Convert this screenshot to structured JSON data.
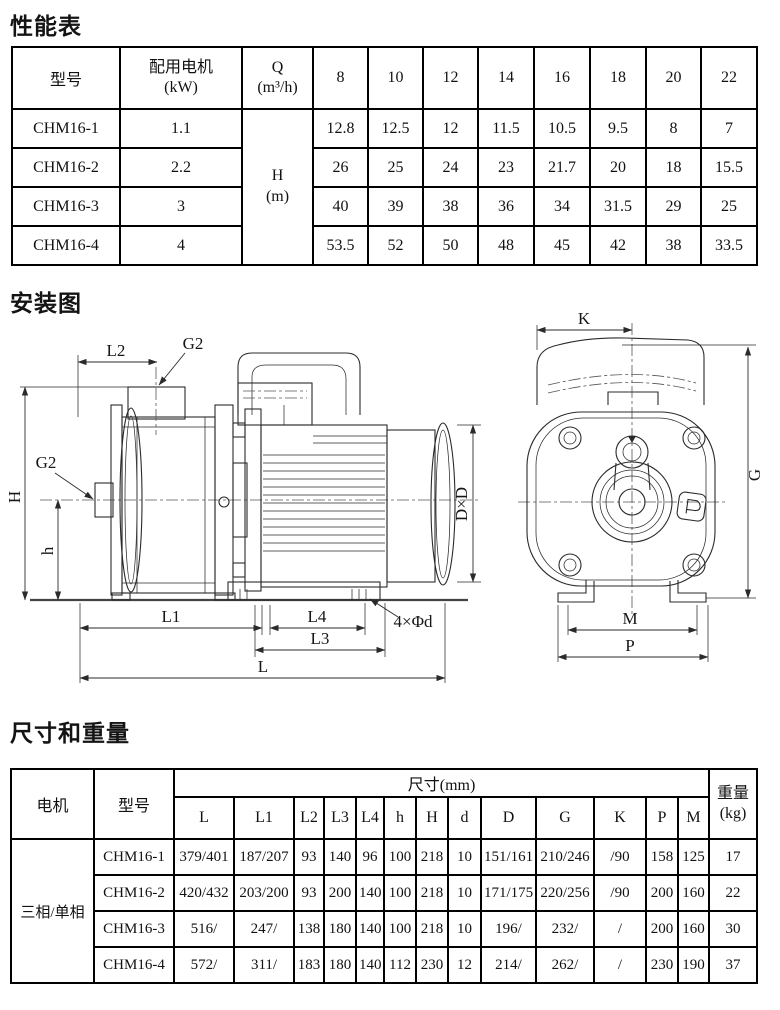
{
  "page": {
    "perf_title": "性能表",
    "install_title": "安装图",
    "dims_title": "尺寸和重量"
  },
  "perf_table": {
    "col_model": "型号",
    "col_motor": "配用电机",
    "col_motor_unit": "(kW)",
    "col_q": "Q",
    "col_q_unit": "(m³/h)",
    "flows": [
      "8",
      "10",
      "12",
      "14",
      "16",
      "18",
      "20",
      "22"
    ],
    "h_label": "H",
    "h_unit": "(m)",
    "rows": [
      {
        "c": [
          "CHM16-1",
          "1.1",
          "12.8",
          "12.5",
          "12",
          "11.5",
          "10.5",
          "9.5",
          "8",
          "7"
        ]
      },
      {
        "c": [
          "CHM16-2",
          "2.2",
          "26",
          "25",
          "24",
          "23",
          "21.7",
          "20",
          "18",
          "15.5"
        ]
      },
      {
        "c": [
          "CHM16-3",
          "3",
          "40",
          "39",
          "38",
          "36",
          "34",
          "31.5",
          "29",
          "25"
        ]
      },
      {
        "c": [
          "CHM16-4",
          "4",
          "53.5",
          "52",
          "50",
          "48",
          "45",
          "42",
          "38",
          "33.5"
        ]
      }
    ]
  },
  "diagram": {
    "side": {
      "l2": "L2",
      "g2_top": "G2",
      "g2_left": "G2",
      "h_total": "H",
      "h_axis": "h",
      "l1": "L1",
      "l4": "L4",
      "l3": "L3",
      "l": "L",
      "holes": "4×Φd",
      "dxd": "D×D"
    },
    "end": {
      "k": "K",
      "g": "G",
      "m": "M",
      "p": "P"
    }
  },
  "dims_table": {
    "col_motor": "电机",
    "col_model": "型号",
    "col_dims": "尺寸(mm)",
    "col_weight": "重量",
    "col_weight_unit": "(kg)",
    "sub_cols": [
      "L",
      "L1",
      "L2",
      "L3",
      "L4",
      "h",
      "H",
      "d",
      "D",
      "G",
      "K",
      "P",
      "M"
    ],
    "motor_value": "三相/单相",
    "rows": [
      {
        "c": [
          "CHM16-1",
          "379/401",
          "187/207",
          "93",
          "140",
          "96",
          "100",
          "218",
          "10",
          "151/161",
          "210/246",
          "/90",
          "158",
          "125",
          "17"
        ]
      },
      {
        "c": [
          "CHM16-2",
          "420/432",
          "203/200",
          "93",
          "200",
          "140",
          "100",
          "218",
          "10",
          "171/175",
          "220/256",
          "/90",
          "200",
          "160",
          "22"
        ]
      },
      {
        "c": [
          "CHM16-3",
          "516/",
          "247/",
          "138",
          "180",
          "140",
          "100",
          "218",
          "10",
          "196/",
          "232/",
          "/",
          "200",
          "160",
          "30"
        ]
      },
      {
        "c": [
          "CHM16-4",
          "572/",
          "311/",
          "183",
          "180",
          "140",
          "112",
          "230",
          "12",
          "214/",
          "262/",
          "/",
          "230",
          "190",
          "37"
        ]
      }
    ]
  }
}
